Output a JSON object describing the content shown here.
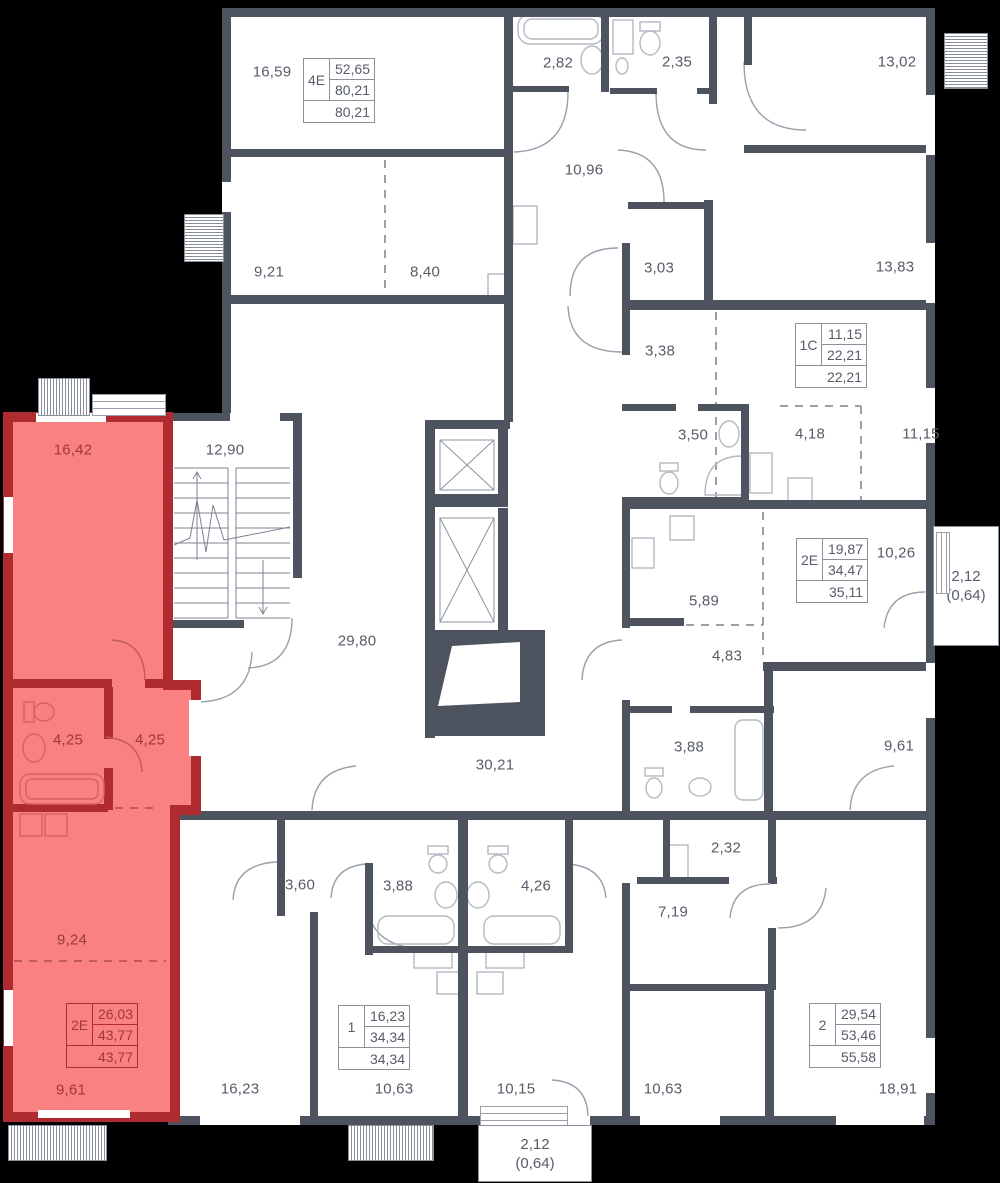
{
  "colors": {
    "background": "#000000",
    "walls": "#4E5360",
    "room_fill": "#FFFFFF",
    "highlight_fill": "#F98181",
    "highlight_walls": "#B02B2F",
    "label_text": "#565C68",
    "highlight_text": "#A03838"
  },
  "rooms": {
    "r_16_59": "16,59",
    "r_2_82": "2,82",
    "r_2_35": "2,35",
    "r_13_02": "13,02",
    "r_10_96": "10,96",
    "r_9_21": "9,21",
    "r_8_40": "8,40",
    "r_3_03": "3,03",
    "r_13_83": "13,83",
    "r_3_38": "3,38",
    "r_3_50": "3,50",
    "r_4_18": "4,18",
    "r_11_15": "11,15",
    "r_stairs_12_90": "12,90",
    "hl_16_42": "16,42",
    "r_29_80": "29,80",
    "r_10_26": "10,26",
    "r_5_89": "5,89",
    "r_4_83": "4,83",
    "hl_4_25_a": "4,25",
    "hl_4_25_b": "4,25",
    "r_3_88_mid": "3,88",
    "r_9_61_mid": "9,61",
    "r_30_21": "30,21",
    "r_2_32": "2,32",
    "r_3_60": "3,60",
    "r_3_88_bot": "3,88",
    "r_4_26": "4,26",
    "r_7_19": "7,19",
    "hl_9_24": "9,24",
    "r_16_23": "16,23",
    "r_10_63_a": "10,63",
    "r_10_15": "10,15",
    "r_10_63_b": "10,63",
    "r_18_91": "18,91",
    "hl_9_61": "9,61"
  },
  "apartments": {
    "a4e": {
      "type": "4Е",
      "v1": "52,65",
      "v2": "80,21",
      "v3": "80,21"
    },
    "a1c": {
      "type": "1С",
      "v1": "11,15",
      "v2": "22,21",
      "v3": "22,21"
    },
    "a2e_right": {
      "type": "2Е",
      "v1": "19,87",
      "v2": "34,47",
      "v3": "35,11"
    },
    "a2e_highlight": {
      "type": "2Е",
      "v1": "26,03",
      "v2": "43,77",
      "v3": "43,77"
    },
    "a1": {
      "type": "1",
      "v1": "16,23",
      "v2": "34,34",
      "v3": "34,34"
    },
    "a2": {
      "type": "2",
      "v1": "29,54",
      "v2": "53,46",
      "v3": "55,58"
    }
  },
  "balconies": {
    "right": {
      "area": "2,12",
      "coefficient": "(0,64)"
    },
    "bottom": {
      "area": "2,12",
      "coefficient": "(0,64)"
    }
  }
}
